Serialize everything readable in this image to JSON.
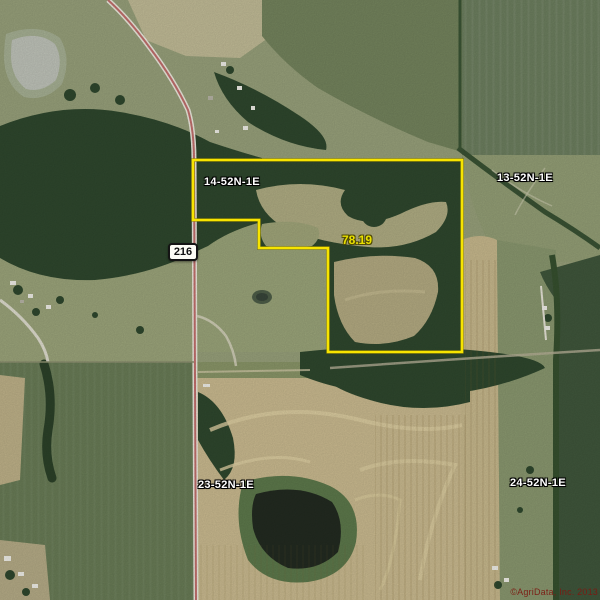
{
  "map": {
    "description": "Aerial parcel plat map",
    "section_labels": [
      {
        "name": "section-14",
        "label": "14-52N-1E"
      },
      {
        "name": "section-13",
        "label": "13-52N-1E"
      },
      {
        "name": "section-23",
        "label": "23-52N-1E"
      },
      {
        "name": "section-24",
        "label": "24-52N-1E"
      }
    ],
    "road_shield": {
      "number": "216"
    },
    "parcel": {
      "acreage_label": "78.19",
      "boundary_color": "#f7e400"
    },
    "attribution": "©AgriData, Inc. 2013",
    "colors": {
      "section_label_text": "#ffffff",
      "section_label_outline": "#000000",
      "acreage_text": "#eae000",
      "road_line": "#c4706e",
      "shield_background": "#fdfdf6",
      "shield_text": "#111111",
      "attribution_text": "#7c1a12"
    }
  }
}
